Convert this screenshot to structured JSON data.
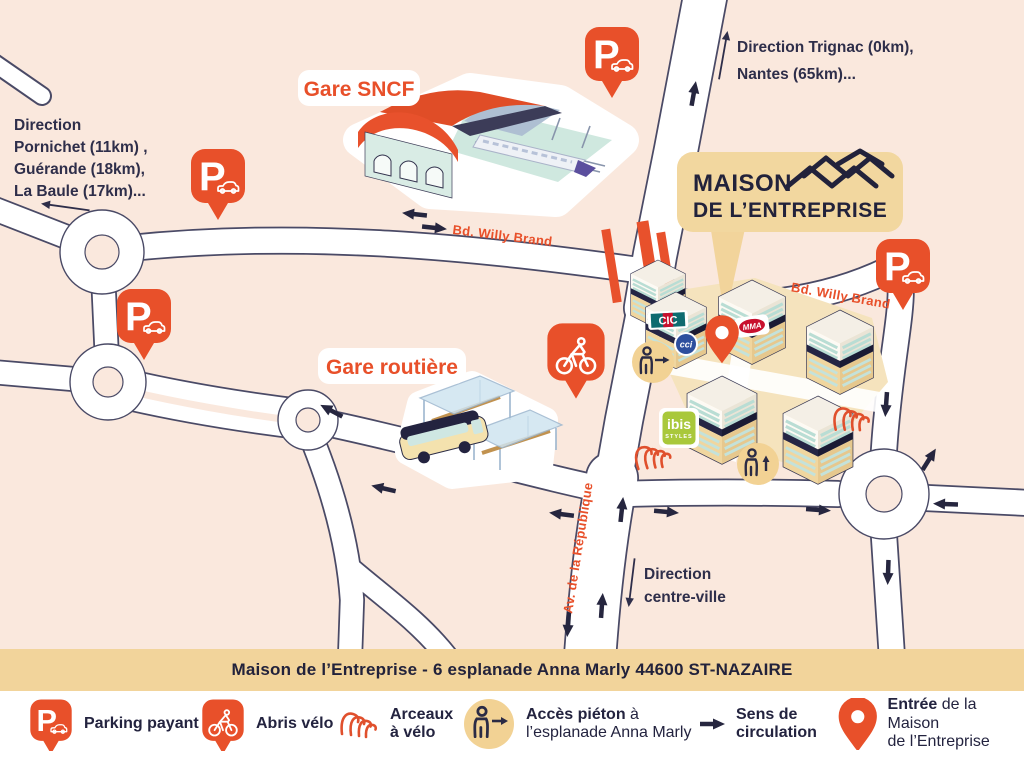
{
  "colors": {
    "background": "#fae8dd",
    "accent_orange": "#e8502a",
    "navy": "#26263f",
    "tan_banner": "#f2d49b",
    "mint": "#cfe7df",
    "arc_red": "#e0502d",
    "ibis_green": "#a9c83b",
    "cci_blue": "#2d4f9e",
    "cic_teal": "#0e6b70",
    "mma_red": "#c8102e",
    "legend_bg": "#ffffff"
  },
  "map": {
    "direction_trignac": {
      "l1": "Direction Trignac (0km),",
      "l2": "Nantes (65km)..."
    },
    "direction_pornichet": {
      "l1": "Direction",
      "l2": "Pornichet (11km) ,",
      "l3": "Guérande (18km),",
      "l4": "La Baule (17km)..."
    },
    "gare_sncf": "Gare SNCF",
    "gare_routiere": "Gare routière",
    "bd_willy_brand": "Bd. Willy Brand",
    "av_republique": "Av. de la République",
    "direction_centre": {
      "l1": "Direction",
      "l2": "centre-ville"
    },
    "logo": {
      "l1": "MAISON",
      "l2": "DE L’ENTREPRISE"
    },
    "building_logos": {
      "cic": "CIC",
      "cci": "cci",
      "mma": "MMA",
      "ibis_l1": "ibis",
      "ibis_l2": "STYLES"
    }
  },
  "icons": {
    "parking_letter": "P"
  },
  "banner": {
    "address": "Maison de l’Entreprise - 6 esplanade Anna Marly 44600 ST-NAZAIRE"
  },
  "legend": {
    "parking": "Parking payant",
    "abris": "Abris vélo",
    "arceaux_l1": "Arceaux",
    "arceaux_l2": "à vélo",
    "acces_bold": "Accès piéton",
    "acces_rest": " à",
    "acces_l2": "l’esplanade Anna Marly",
    "sens_l1": "Sens de",
    "sens_l2": "circulation",
    "entree_bold": "Entrée",
    "entree_rest": " de la Maison",
    "entree_l2": "de l’Entreprise"
  }
}
